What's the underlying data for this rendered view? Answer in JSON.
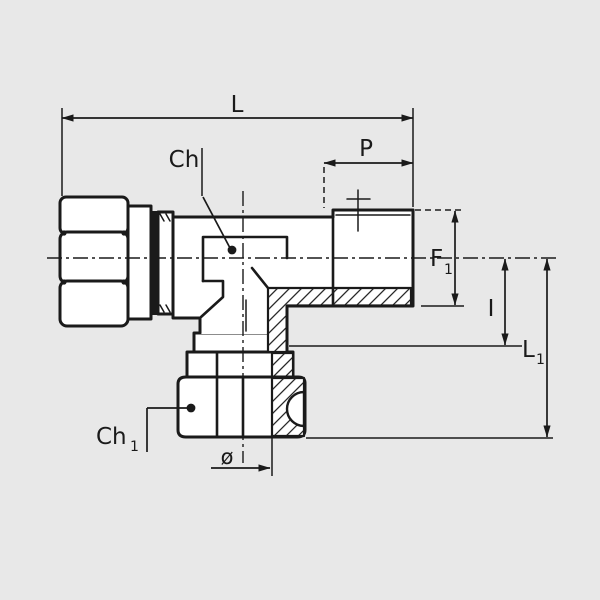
{
  "drawing": {
    "labels": {
      "overall_length": "L",
      "body_hex": "Ch",
      "thread_length": "P",
      "f1_main": "F",
      "f1_sub": "1",
      "insertion_depth": "I",
      "l1_main": "L",
      "l1_sub": "1",
      "ch1_main": "Ch",
      "ch1_sub": "1",
      "diameter": "ø"
    },
    "colors": {
      "background": "#e8e8e8",
      "ink": "#1a1a1a",
      "paper_fill": "#ffffff"
    }
  }
}
